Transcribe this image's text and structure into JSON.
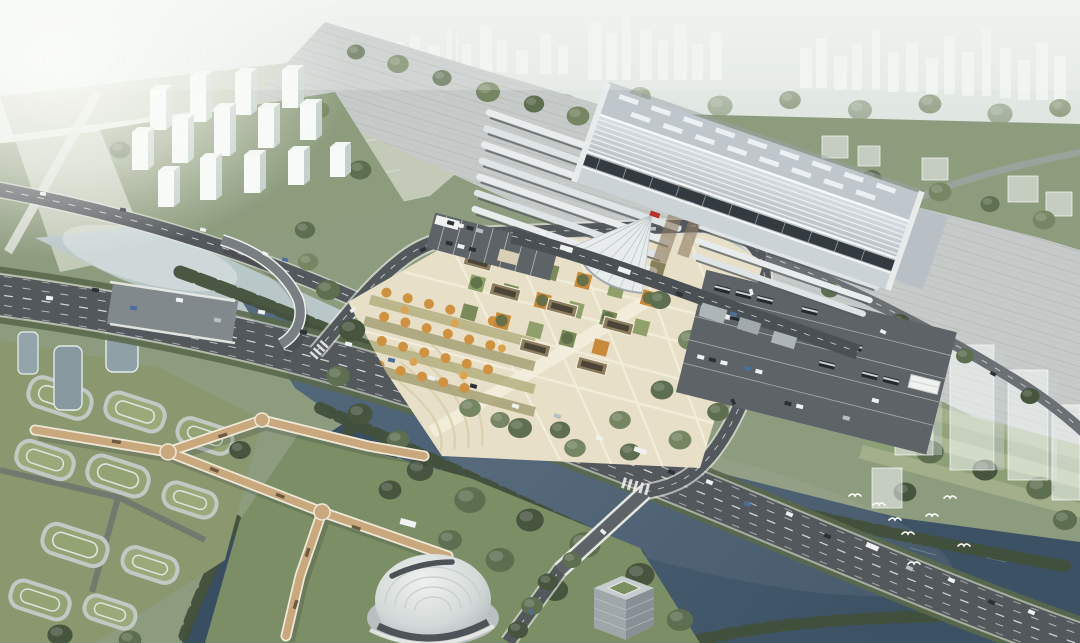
{
  "scene": {
    "type": "aerial-architectural-rendering",
    "subject": "Bird's-eye CG rendering of a large high-speed railway station with forecourt plaza, bus yards, looping access roads, a riverfront park with angular timber footbridges, a shell-roofed pavilion, terraced green-roof buildings and a hazy city skyline beyond",
    "atmosphere": "hazy daylight with strong sun glare from the upper left",
    "visible_text": [],
    "station": {
      "emblem": "small red railway emblem on entrance gable (illegible at this scale)",
      "west_platform_canopy_count": 7,
      "east_platform_canopy_count": 8,
      "entrance_canopy": "white fan / tent shaped canopy at south-west entrance"
    },
    "counts": {
      "residential_towers_upper_left": 14,
      "ghost_future_buildings_right": 5,
      "terraced_green_roof_buildings": 10,
      "birds_over_river": 8
    },
    "objects": [
      {
        "name": "distant-city-skyline",
        "desc": "white high-rises fading into haze across the top"
      },
      {
        "name": "rail-corridor",
        "desc": "wide grey track yard running diagonally behind the station"
      },
      {
        "name": "station-main-hall",
        "desc": "long silver ribbed roof with skylight rows and dark glass band"
      },
      {
        "name": "platform-canopies",
        "desc": "thin wavy silver canopy strips flanking the hall"
      },
      {
        "name": "station-plaza",
        "desc": "cream paved forecourt with grid of green and autumn-orange tree beds and sunken courts"
      },
      {
        "name": "bus-parking-lot",
        "desc": "dark lot east of plaza with rows of buses and two white tent canopies"
      },
      {
        "name": "boulevard",
        "desc": "curved multi-lane arterial with heavy traffic between plaza and river"
      },
      {
        "name": "loop-road",
        "desc": "access loop around the plaza continuing as a river-crossing avenue"
      },
      {
        "name": "river",
        "desc": "steel-blue river, pale upstream under the glare, with a branch to the lower left"
      },
      {
        "name": "footbridge-network",
        "desc": "tan angular boardwalk bridges with X junctions over the river branch"
      },
      {
        "name": "terraced-buildings",
        "desc": "oval terraced buildings with green roofs on the lower-left bank"
      },
      {
        "name": "shell-pavilion",
        "desc": "white teardrop shell-roof building at bottom centre"
      },
      {
        "name": "cube-building",
        "desc": "grey cube with sunken green courtyard at bottom centre-right"
      },
      {
        "name": "ghost-buildings",
        "desc": "translucent future development slabs on the right riverbank"
      },
      {
        "name": "birds",
        "desc": "white birds flying over the river on the right"
      }
    ]
  },
  "palette": {
    "haze_top": "#f1f4f1",
    "city_base": "#dde4df",
    "city_tower": "#f7faf8",
    "city_tower_side": "#c4cfcb",
    "city_tree": "#9fae9c",
    "glare": "#fcfdfa",
    "field": "#c3cab8",
    "field_line": "#e9ece5",
    "lawn": "#8d9c7d",
    "lawn_light": "#a5b28c",
    "lawn_stripe": "#b2bd95",
    "tree_dark": "#47553e",
    "tree_mid": "#5e6e50",
    "tree_light": "#768562",
    "tree_pale": "#8e9c82",
    "rail_yard": "#c6cac8",
    "rail_stripe": "#b3b8b6",
    "asphalt": "#53585c",
    "asphalt_light": "#676d71",
    "road_casing": "#e9eae4",
    "lane": "#e8eae8",
    "verge": "#5a684c",
    "plaza": "#e7dfc7",
    "plaza_path": "#f3eedd",
    "plaza_terrace": "#d9d0ae",
    "sunken": "#8b7c5e",
    "sunken_dark": "#4c4437",
    "orange": "#c8893b",
    "orange_light": "#dba44f",
    "bed_green": "#7a8a58",
    "lot": "#5d6367",
    "bus_dark": "#24292d",
    "bus_roof": "#ced3d7",
    "car_white": "#f0f2f2",
    "car_dark": "#2c3135",
    "car_blue": "#4c6f9a",
    "car_silver": "#b9bfc2",
    "canopy": "#e8eced",
    "canopy_shadow": "#565c60",
    "canopy_under": "#8d7960",
    "hall_roof": "#cdd4d9",
    "hall_roof_dark": "#aab2b8",
    "hall_rib": "#eff2f4",
    "hall_skylight_band": "#bfc7cc",
    "hall_glass": "#343b40",
    "emblem": "#b7312b",
    "tent": "#f0f2f1",
    "water_pale": "#b9c7c8",
    "water_main": "#4c6175",
    "water_deep": "#3a4e61",
    "sparkle": "#a9bcc6",
    "bank": "#42503b",
    "deck": "#c9a87e",
    "deck_edge": "#efe9da",
    "deck_dark": "#6b5a41",
    "terrace_roof": "#94a374",
    "terrace_band": "#c2c8c3",
    "terrace_inner": "#dfe3de",
    "glass_bldg": "#8fa1a7",
    "dome_hi": "#e9edec",
    "dome_lo": "#b2bac0",
    "dome_dark": "#394044",
    "dome_rib": "#c7cecd",
    "cube_top": "#c7cdcf",
    "cube_front": "#a0a7ab",
    "cube_side": "#899095",
    "court_green": "#7c8f60",
    "ghost_fill": "rgba(248,252,251,0.52)",
    "ghost_edge": "rgba(255,255,255,0.8)",
    "ghost_side": "rgba(198,208,208,0.45)",
    "bird": "#ffffff"
  }
}
